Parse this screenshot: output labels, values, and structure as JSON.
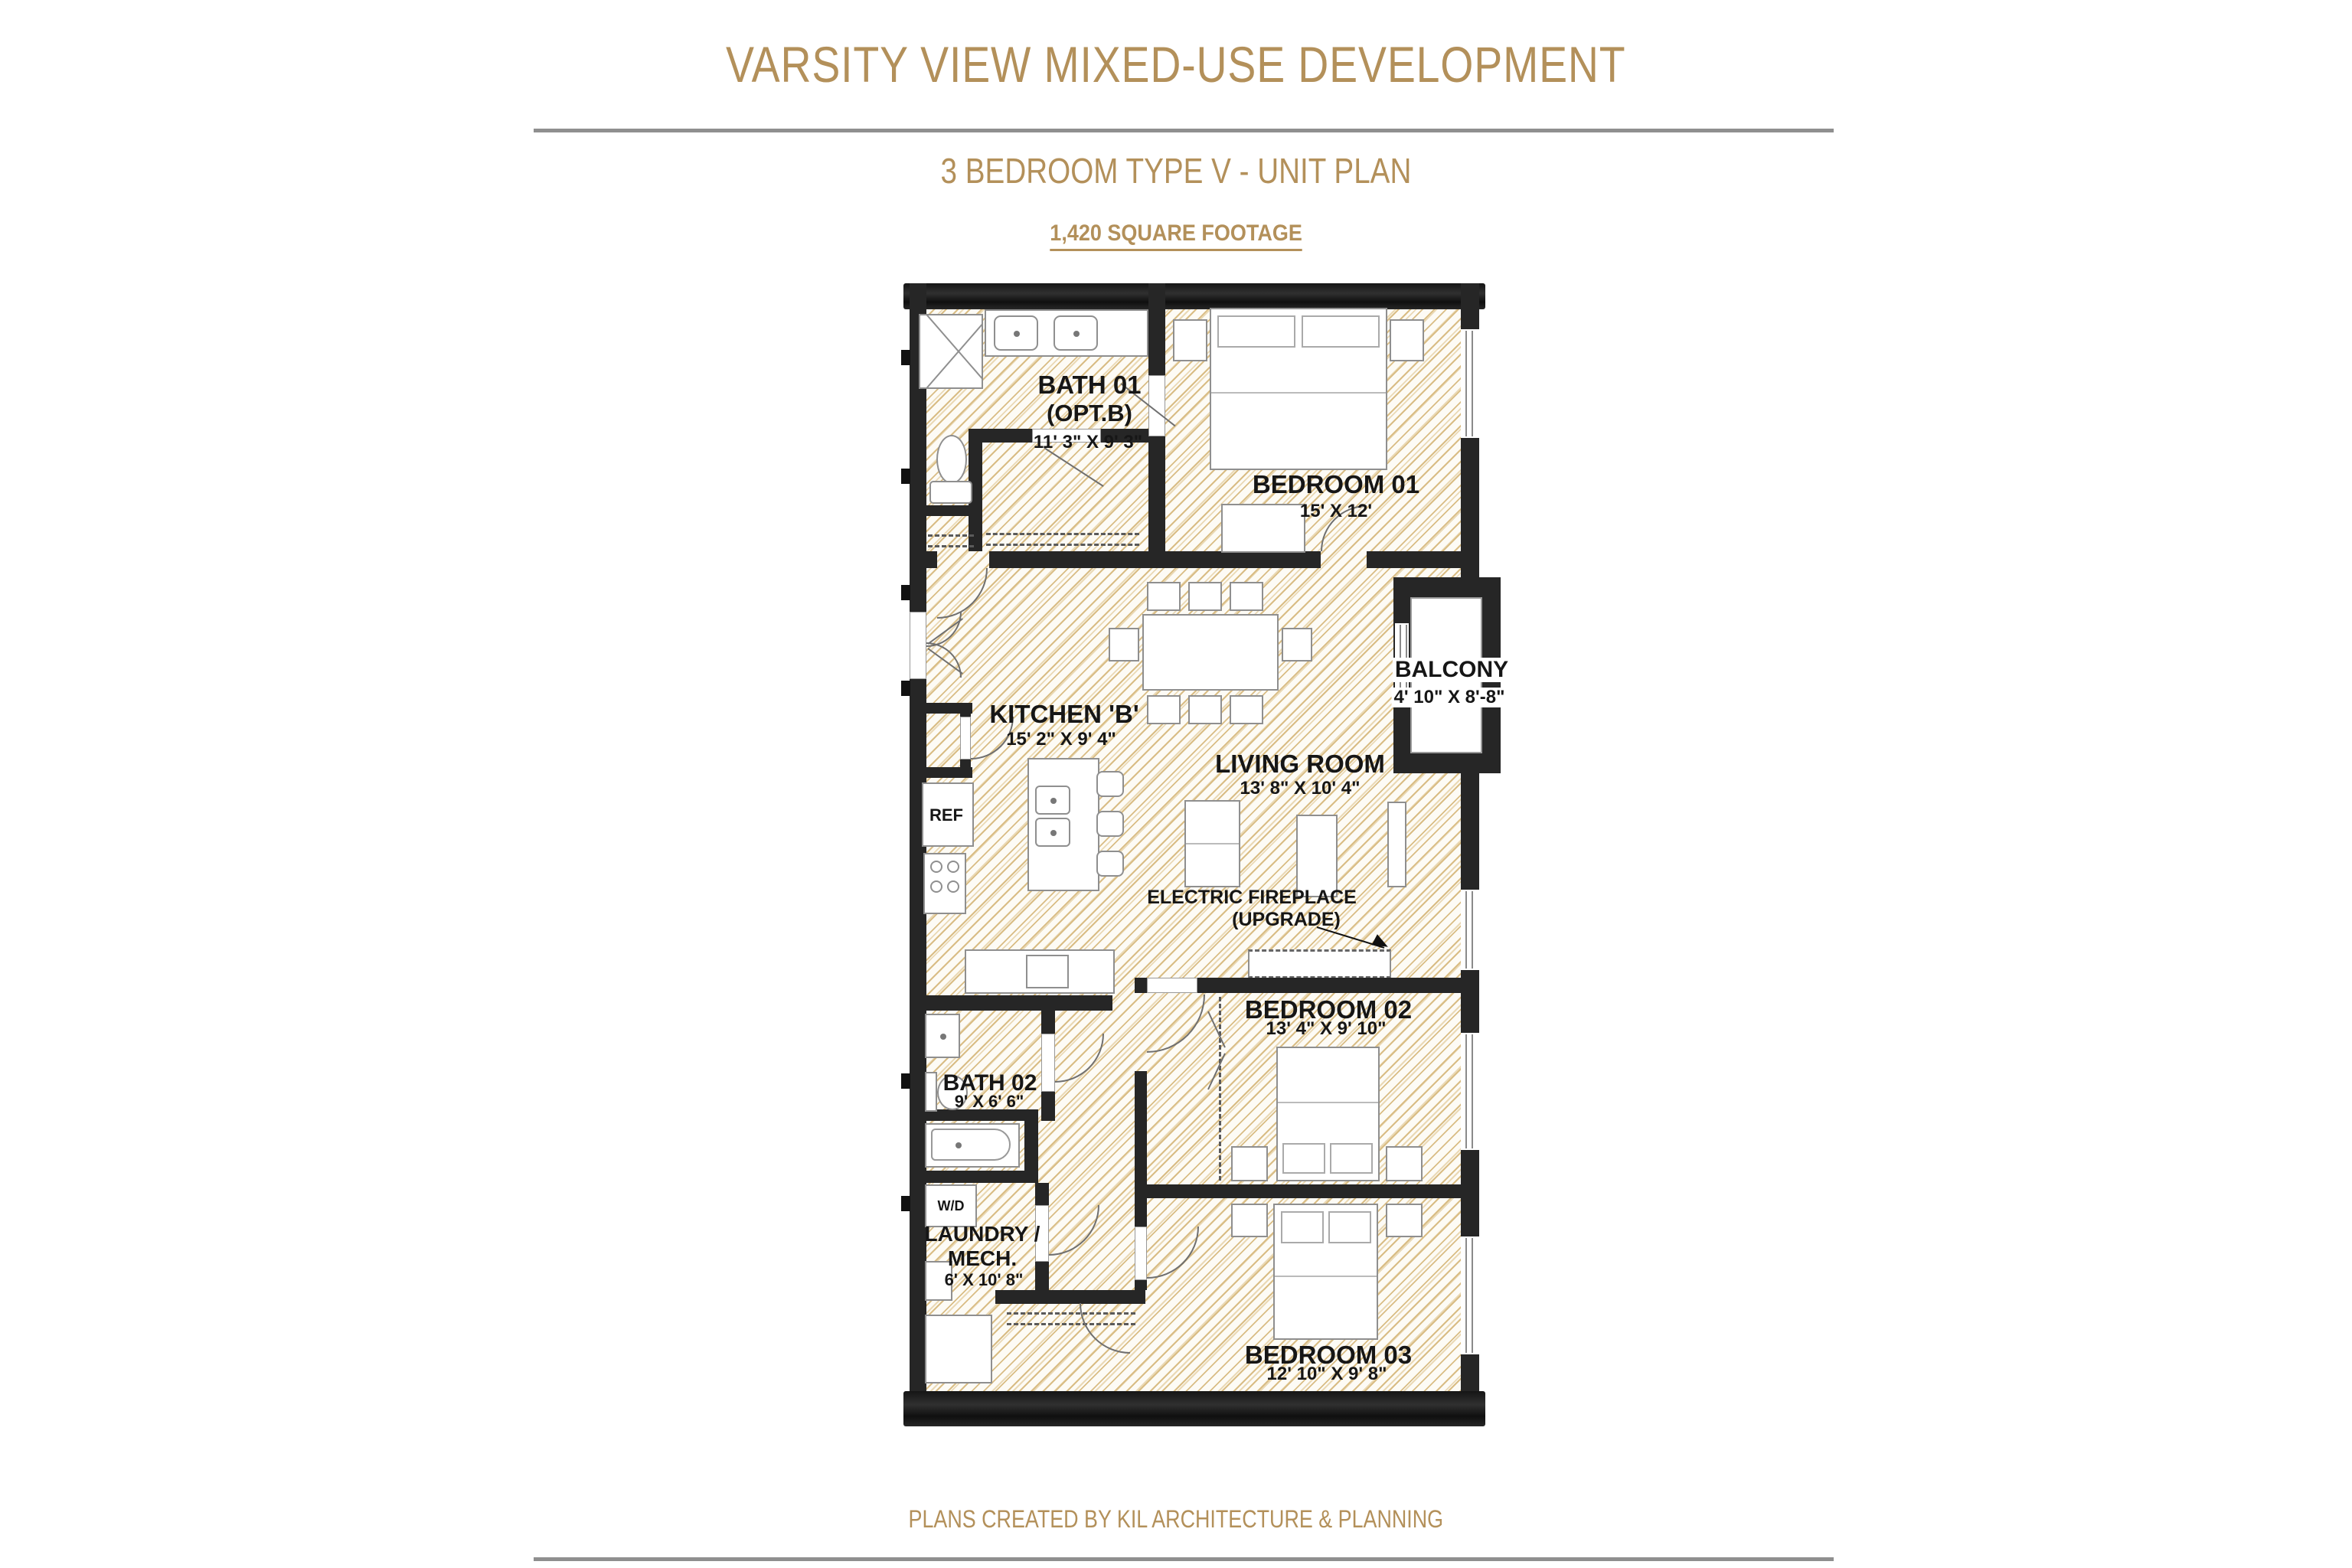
{
  "header": {
    "title": "VARSITY VIEW MIXED-USE DEVELOPMENT",
    "subtitle": "3 BEDROOM TYPE V - UNIT PLAN",
    "square_footage": "1,420 SQUARE FOOTAGE"
  },
  "plan": {
    "rooms": {
      "bath01": {
        "name": "BATH 01",
        "variant": "(OPT.B)",
        "dims": "11' 3\" X 9' 3\""
      },
      "bedroom01": {
        "name": "BEDROOM 01",
        "dims": "15' X 12'"
      },
      "balcony": {
        "name": "BALCONY",
        "dims": "4' 10\" X 8'-8\""
      },
      "kitchen": {
        "name": "KITCHEN 'B'",
        "dims": "15' 2\" X 9' 4\""
      },
      "living": {
        "name": "LIVING ROOM",
        "dims": "13' 8\" X 10' 4\""
      },
      "bedroom02": {
        "name": "BEDROOM 02",
        "dims": "13' 4\" X 9' 10\""
      },
      "bath02": {
        "name": "BATH 02",
        "dims": "9' X 6' 6\""
      },
      "laundry": {
        "name": "LAUNDRY /",
        "name2": "MECH.",
        "dims": "6' X 10' 8\""
      },
      "bedroom03": {
        "name": "BEDROOM 03",
        "dims": "12' 10\" X 9' 8\""
      }
    },
    "annotations": {
      "fireplace_line1": "ELECTRIC FIREPLACE",
      "fireplace_line2": "(UPGRADE)",
      "fridge": "REF",
      "washer_dryer": "W/D"
    },
    "colors": {
      "accent_gold": "#b3905a",
      "wall": "#262626",
      "hatch_line": "#d9bd85",
      "divider_gray": "#8f8f8f"
    }
  },
  "footer": {
    "credit": "PLANS CREATED BY KIL ARCHITECTURE & PLANNING"
  }
}
